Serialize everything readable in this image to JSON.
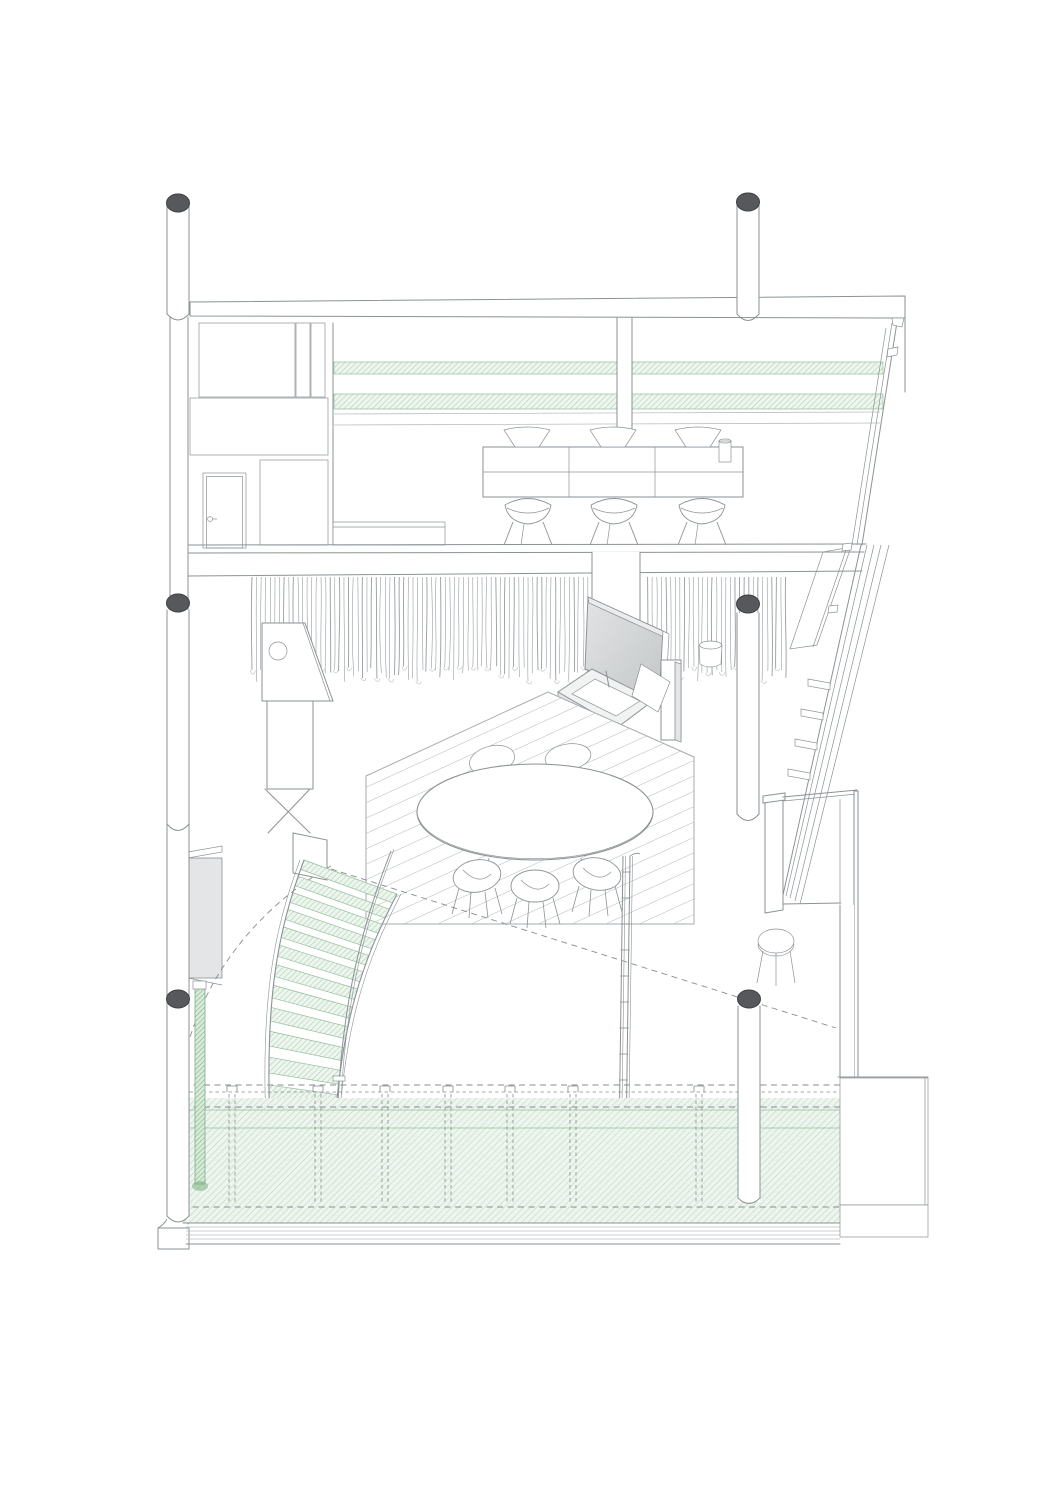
{
  "figure": {
    "label": "Axonometric interior section drawing of a two-level dwelling",
    "parts": {
      "roof_beam": "roof-slab-beam",
      "columns": "round-steel-columns-with-dark-caps",
      "upper_level": "kitchen-with-counter-stools-and-green-shelf-strips",
      "mid_level": "dining-deck-with-oval-table-tv-and-curtain",
      "stair": "curved-stair-with-green-treads",
      "terrace": "green-hatched-terrace-deck",
      "facade": "sloped-glazed-facade-right-side"
    }
  },
  "colors": {
    "line": "#8b9296",
    "lineLight": "#b9bec0",
    "dash": "#878d91",
    "capDark": "#57585c",
    "capEdge": "#3f4043",
    "greenEdge": "#93bf9b",
    "greenHatch": "#a9cfb0",
    "greenHatchLight": "#bcd9c0",
    "greenBg": "#eef5ee",
    "greenDark": "#7cb184",
    "greenBarBg": "#d8ead9",
    "softGray": "#e4e5e6",
    "tvGrayA": "#d9dbdc",
    "tvGrayB": "#c3c6c7"
  },
  "curtain": {
    "x1": 252,
    "x2": 790,
    "gap1": 588,
    "gap2": 644,
    "top": 577,
    "hemMin": 666,
    "hemMax": 682,
    "step": 4.6
  },
  "stair": {
    "left": [
      [
        304,
        860
      ],
      [
        278,
        930
      ],
      [
        263,
        1000
      ],
      [
        271,
        1148
      ]
    ],
    "right": [
      [
        397,
        894
      ],
      [
        363,
        960
      ],
      [
        340,
        1020
      ],
      [
        333,
        1150
      ]
    ],
    "rail": [
      [
        391,
        851
      ],
      [
        362,
        925
      ],
      [
        343,
        1000
      ],
      [
        338,
        1102
      ]
    ],
    "treads": 13
  },
  "terrace_posts": [
    232,
    318,
    385,
    448,
    510,
    573,
    699
  ]
}
